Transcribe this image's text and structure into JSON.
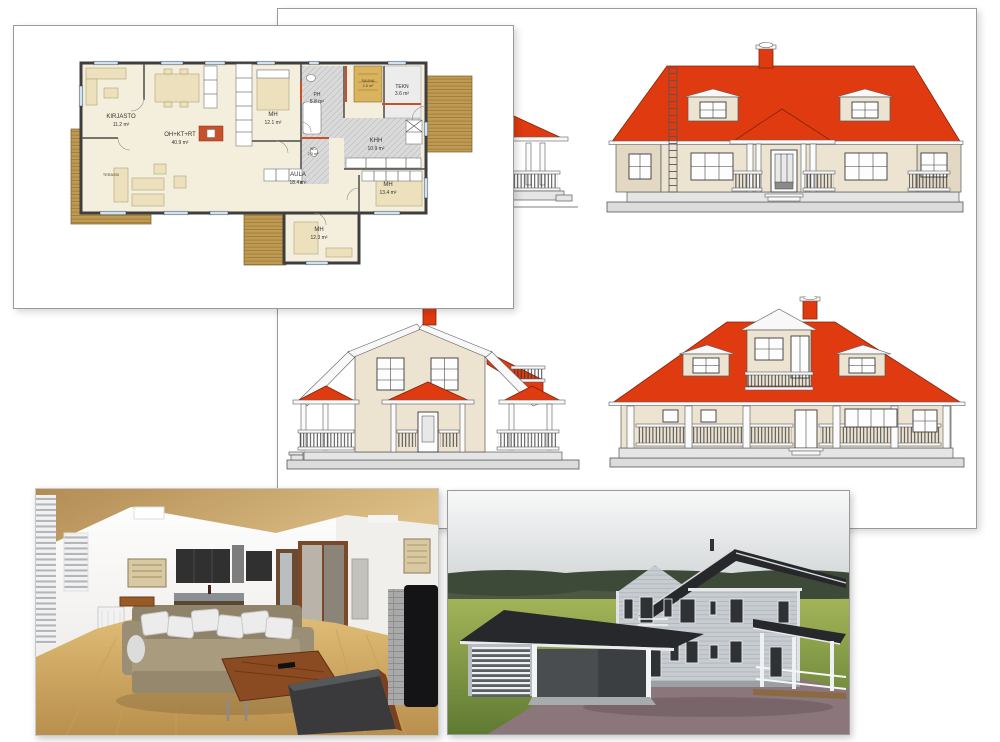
{
  "floorplan": {
    "rooms": [
      {
        "name": "KIRJASTO",
        "area": "11.2 m²"
      },
      {
        "name": "OH+KT+RT",
        "area": "40.9 m²"
      },
      {
        "name": "MH",
        "area": "12.1 m²"
      },
      {
        "name": "PH",
        "area": "5.8 m²"
      },
      {
        "name": "SAUNA",
        "area": "2.5 m²"
      },
      {
        "name": "TEKN",
        "area": "3.6 m²"
      },
      {
        "name": "KHH",
        "area": "10.9 m²"
      },
      {
        "name": "WC",
        "area": "2.3 m²"
      },
      {
        "name": "AULA",
        "area": "18.4 m²"
      },
      {
        "name": "MH",
        "area": "13.4 m²"
      },
      {
        "name": "MH",
        "area": "12.3 m²"
      },
      {
        "name": "TERASSI",
        "area": ""
      }
    ]
  },
  "colors": {
    "page_bg": "#ffffff",
    "sheet_border": "#9a9a9a",
    "roof_red": "#e03a10",
    "elevation_wall": "#ece3d1",
    "plan_floor": "#f4eedd",
    "plan_wet": "#dadada",
    "plan_wood": "#bf9a52",
    "plan_wall": "#3e3e3e",
    "plan_window": "#cfe3f2",
    "plan_accent": "#c8502a",
    "render_grass": "#7b9a43",
    "render_roof": "#26282b",
    "render_siding": "#c7ccd1",
    "render_driveway": "#8b767c",
    "interior_ceiling": "#c49a62",
    "interior_floor": "#d4b06c",
    "interior_sofa": "#a29377",
    "interior_table": "#8a4a22"
  }
}
